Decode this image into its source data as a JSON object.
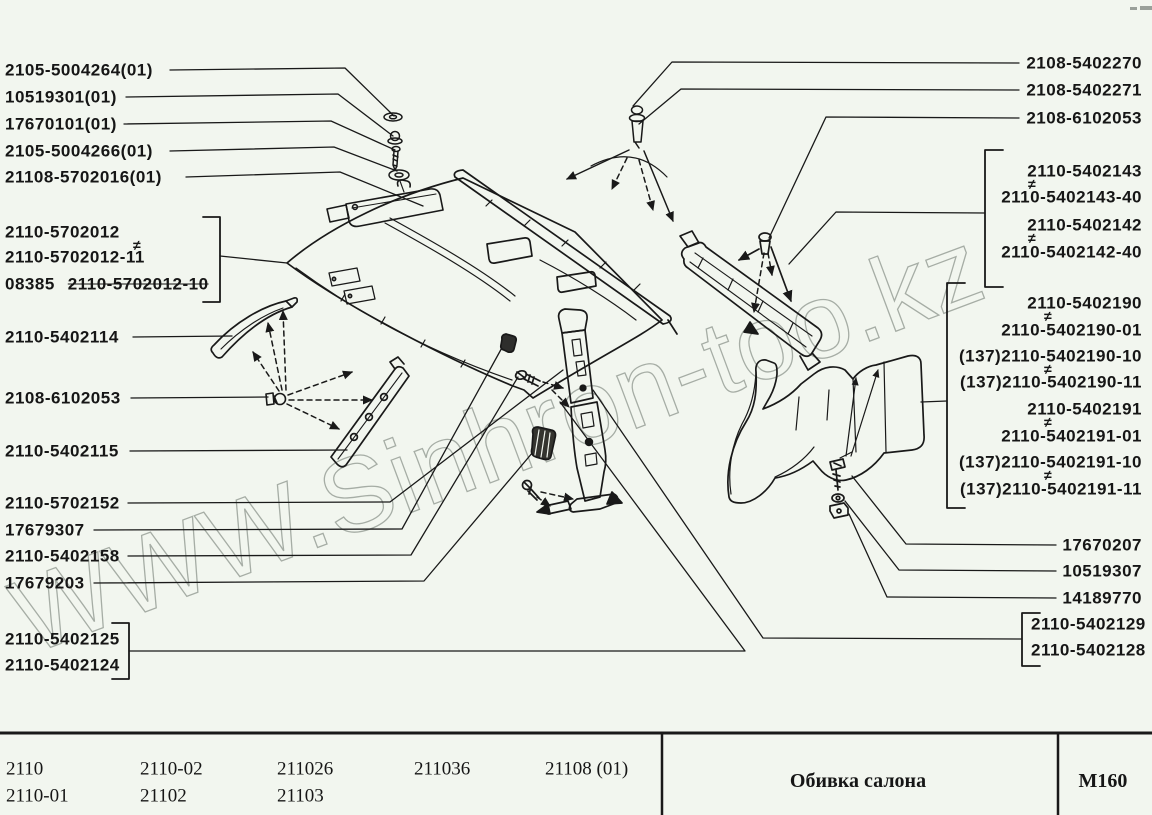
{
  "symbols": {
    "not_equal": "≠"
  },
  "watermark": "WWW.Sinhron-too.kz",
  "colors": {
    "background": "#f2f6ef",
    "ink": "#191919",
    "watermark": "#878f87"
  },
  "callouts": {
    "top_left": [
      "2105-5004264(01)",
      "10519301(01)",
      "17670101(01)",
      "2105-5004266(01)",
      "21108-5702016(01)"
    ],
    "front_pillar_group": {
      "line1": "2110-5702012",
      "line2": "2110-5702012-11",
      "line3_prefix": "08385",
      "line3_struck": "2110-5702012-10"
    },
    "left": [
      "2110-5402114",
      "2108-6102053",
      "2110-5402115",
      "2110-5702152",
      "17679307",
      "2110-5402158",
      "17679203"
    ],
    "bottom_left_group": [
      "2110-5402125",
      "2110-5402124"
    ],
    "top_right": [
      "2108-5402270",
      "2108-5402271",
      "2108-6102053"
    ],
    "rear_pillar_group": [
      "2110-5402143",
      "2110-5402143-40",
      "2110-5402142",
      "2110-5402142-40"
    ],
    "wheelhouse_group": [
      "2110-5402190",
      "2110-5402190-01",
      "(137)2110-5402190-10",
      "(137)2110-5402190-11",
      "2110-5402191",
      "2110-5402191-01",
      "(137)2110-5402191-10",
      "(137)2110-5402191-11"
    ],
    "bottom_right": [
      "17670207",
      "10519307",
      "14189770"
    ],
    "shelf_group": [
      "2110-5402129",
      "2110-5402128"
    ]
  },
  "table": {
    "model_codes_row1": [
      "2110",
      "2110-02",
      "211026",
      "211036",
      "21108 (01)"
    ],
    "model_codes_row2": [
      "2110-01",
      "21102",
      "21103"
    ],
    "section_title": "Обивка салона",
    "page_code": "М160"
  }
}
